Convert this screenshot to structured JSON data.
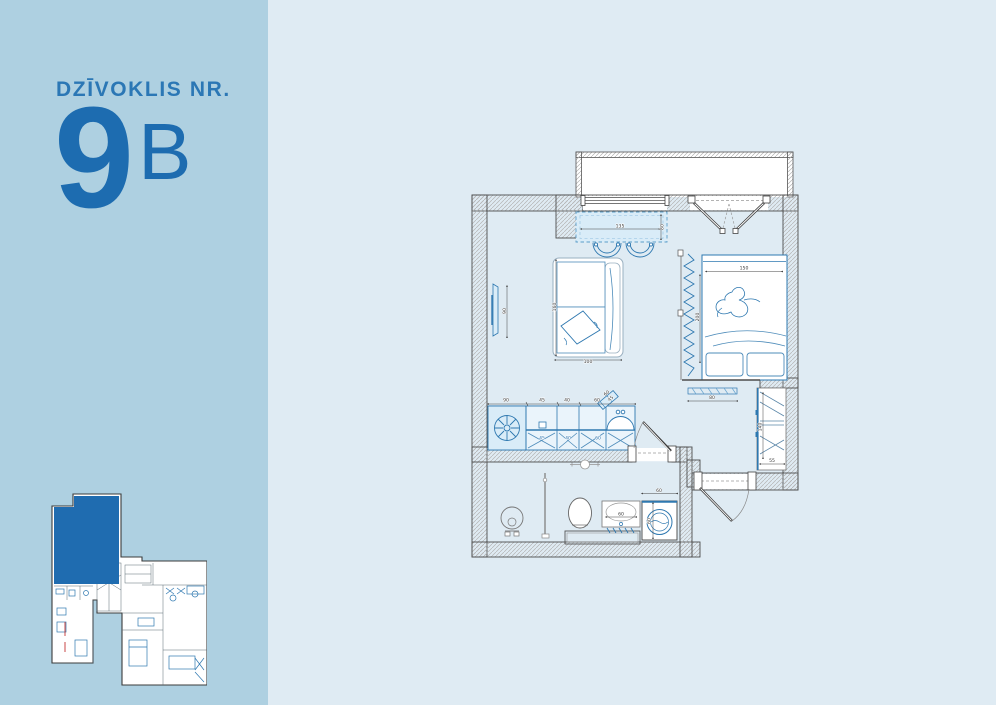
{
  "sidebar": {
    "title": "DZĪVOKLIS NR.",
    "apartment_number": "9",
    "apartment_letter": "B"
  },
  "colors": {
    "sidebar_bg": "#aed0e1",
    "page_bg": "#dfebf3",
    "brand_blue": "#1d6cb0",
    "title_blue": "#2b77b5",
    "plan_furniture_blue": "#2e78b0",
    "plan_fill_light": "#d9ecf8",
    "mini_plan_highlight": "#1f6cb0",
    "wall_outline": "#4d4d4d"
  },
  "floor_plan": {
    "dimension_labels": [
      {
        "text": "135",
        "x": 160,
        "y": 87.6
      },
      {
        "text": "80",
        "x": 203.6,
        "y": 87,
        "rot": -90
      },
      {
        "text": "90",
        "x": 46,
        "y": 171,
        "rot": -90
      },
      {
        "text": "160",
        "x": 96,
        "y": 167,
        "rot": -90
      },
      {
        "text": "100",
        "x": 128,
        "y": 222.8
      },
      {
        "text": "150",
        "x": 284,
        "y": 129.6
      },
      {
        "text": "200",
        "x": 238.8,
        "y": 177,
        "rot": -90
      },
      {
        "text": "80",
        "x": 252,
        "y": 259.2
      },
      {
        "text": "140",
        "x": 301.6,
        "y": 287,
        "rot": -90
      },
      {
        "text": "55",
        "x": 312,
        "y": 321.8
      },
      {
        "text": "90",
        "x": 46,
        "y": 261.6
      },
      {
        "text": "45",
        "x": 82,
        "y": 261.6
      },
      {
        "text": "40",
        "x": 107,
        "y": 261.6
      },
      {
        "text": "60",
        "x": 137,
        "y": 261.6
      },
      {
        "text": "60",
        "x": 147.5,
        "y": 254.2,
        "rot": -40
      },
      {
        "text": "45",
        "x": 151.5,
        "y": 259.6,
        "rot": -40
      },
      {
        "text": "45",
        "x": 82,
        "y": 299.4,
        "blue": true
      },
      {
        "text": "40",
        "x": 108,
        "y": 299.4,
        "blue": true
      },
      {
        "text": "60",
        "x": 138,
        "y": 299.4,
        "blue": true
      },
      {
        "text": "60",
        "x": 161,
        "y": 375.6
      },
      {
        "text": "60",
        "x": 199,
        "y": 351.8
      },
      {
        "text": "60",
        "x": 190.6,
        "y": 381,
        "rot": -90
      }
    ]
  }
}
